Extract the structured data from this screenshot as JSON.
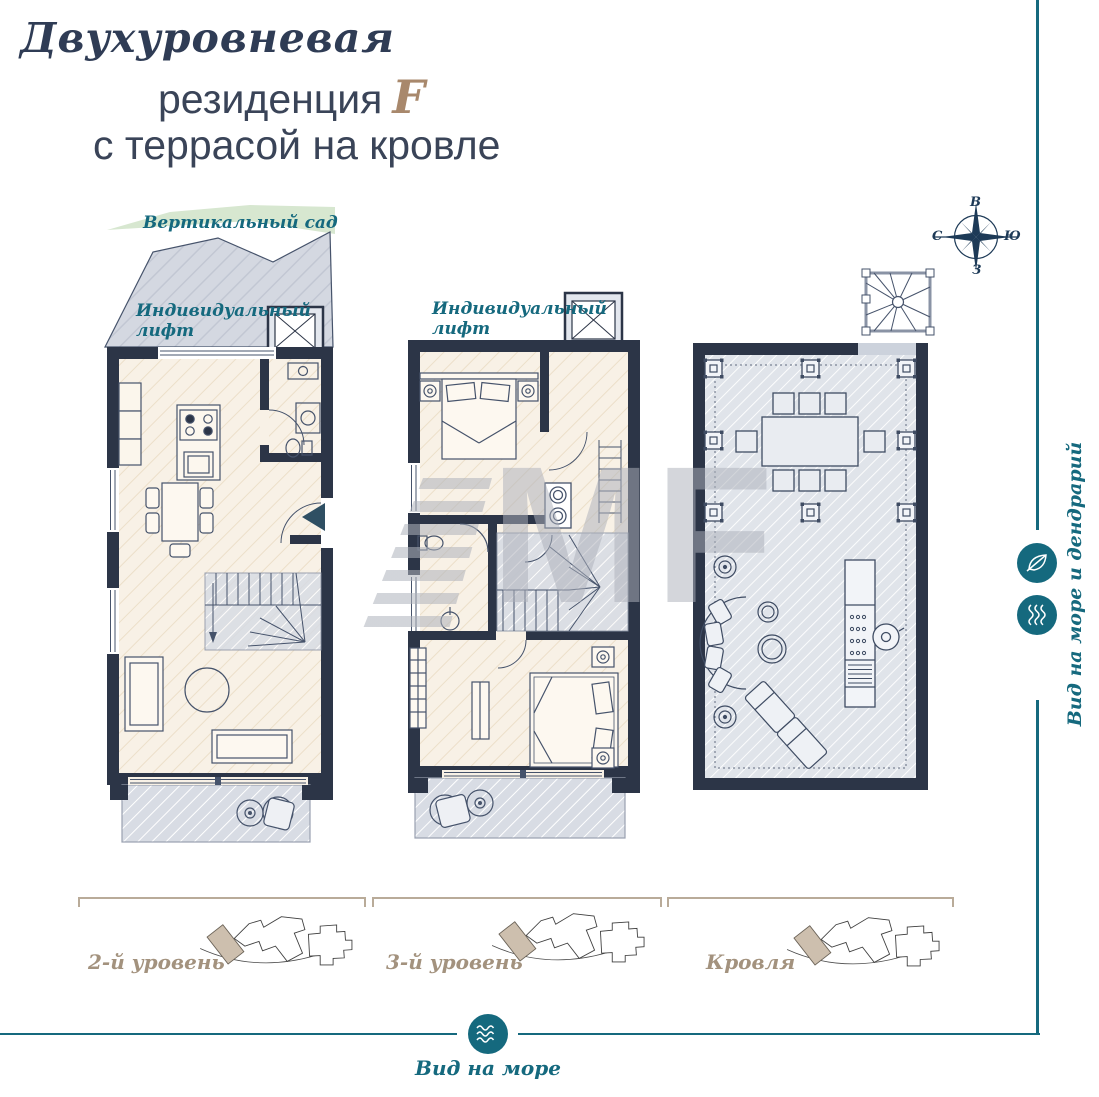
{
  "colors": {
    "teal": "#15697e",
    "navy_wall": "#2c3547",
    "taupe": "#a3927e",
    "cream_floor": "#f8f1e6",
    "terrace_gray": "#d8dce4",
    "garden_green": "#d7e7d0",
    "title_navy": "#2f3c55",
    "accent_brown": "#a8886c"
  },
  "title": {
    "line1": "Двухуровневая",
    "line2_text": "резиденция",
    "line2_accent": "F",
    "line3": "с террасой на кровле"
  },
  "compass": {
    "top": "В",
    "right": "Ю",
    "left": "С",
    "bottom": "З"
  },
  "plan_level2": {
    "garden_label": "Вертикальный сад",
    "lift_line1": "Индивидуальный",
    "lift_line2": "лифт",
    "level_label": "2-й уровень"
  },
  "plan_level3": {
    "lift_line1": "Индивидуальный",
    "lift_line2": "лифт",
    "level_label": "3-й уровень"
  },
  "plan_roof": {
    "level_label": "Кровля"
  },
  "sidebar": {
    "view_label": "Вид на море и дендрарий",
    "icons": [
      "leaf-icon",
      "waves-icon"
    ]
  },
  "footer": {
    "view_label": "Вид на море",
    "icon": "waves-icon"
  },
  "watermark": {
    "text": "MF"
  }
}
